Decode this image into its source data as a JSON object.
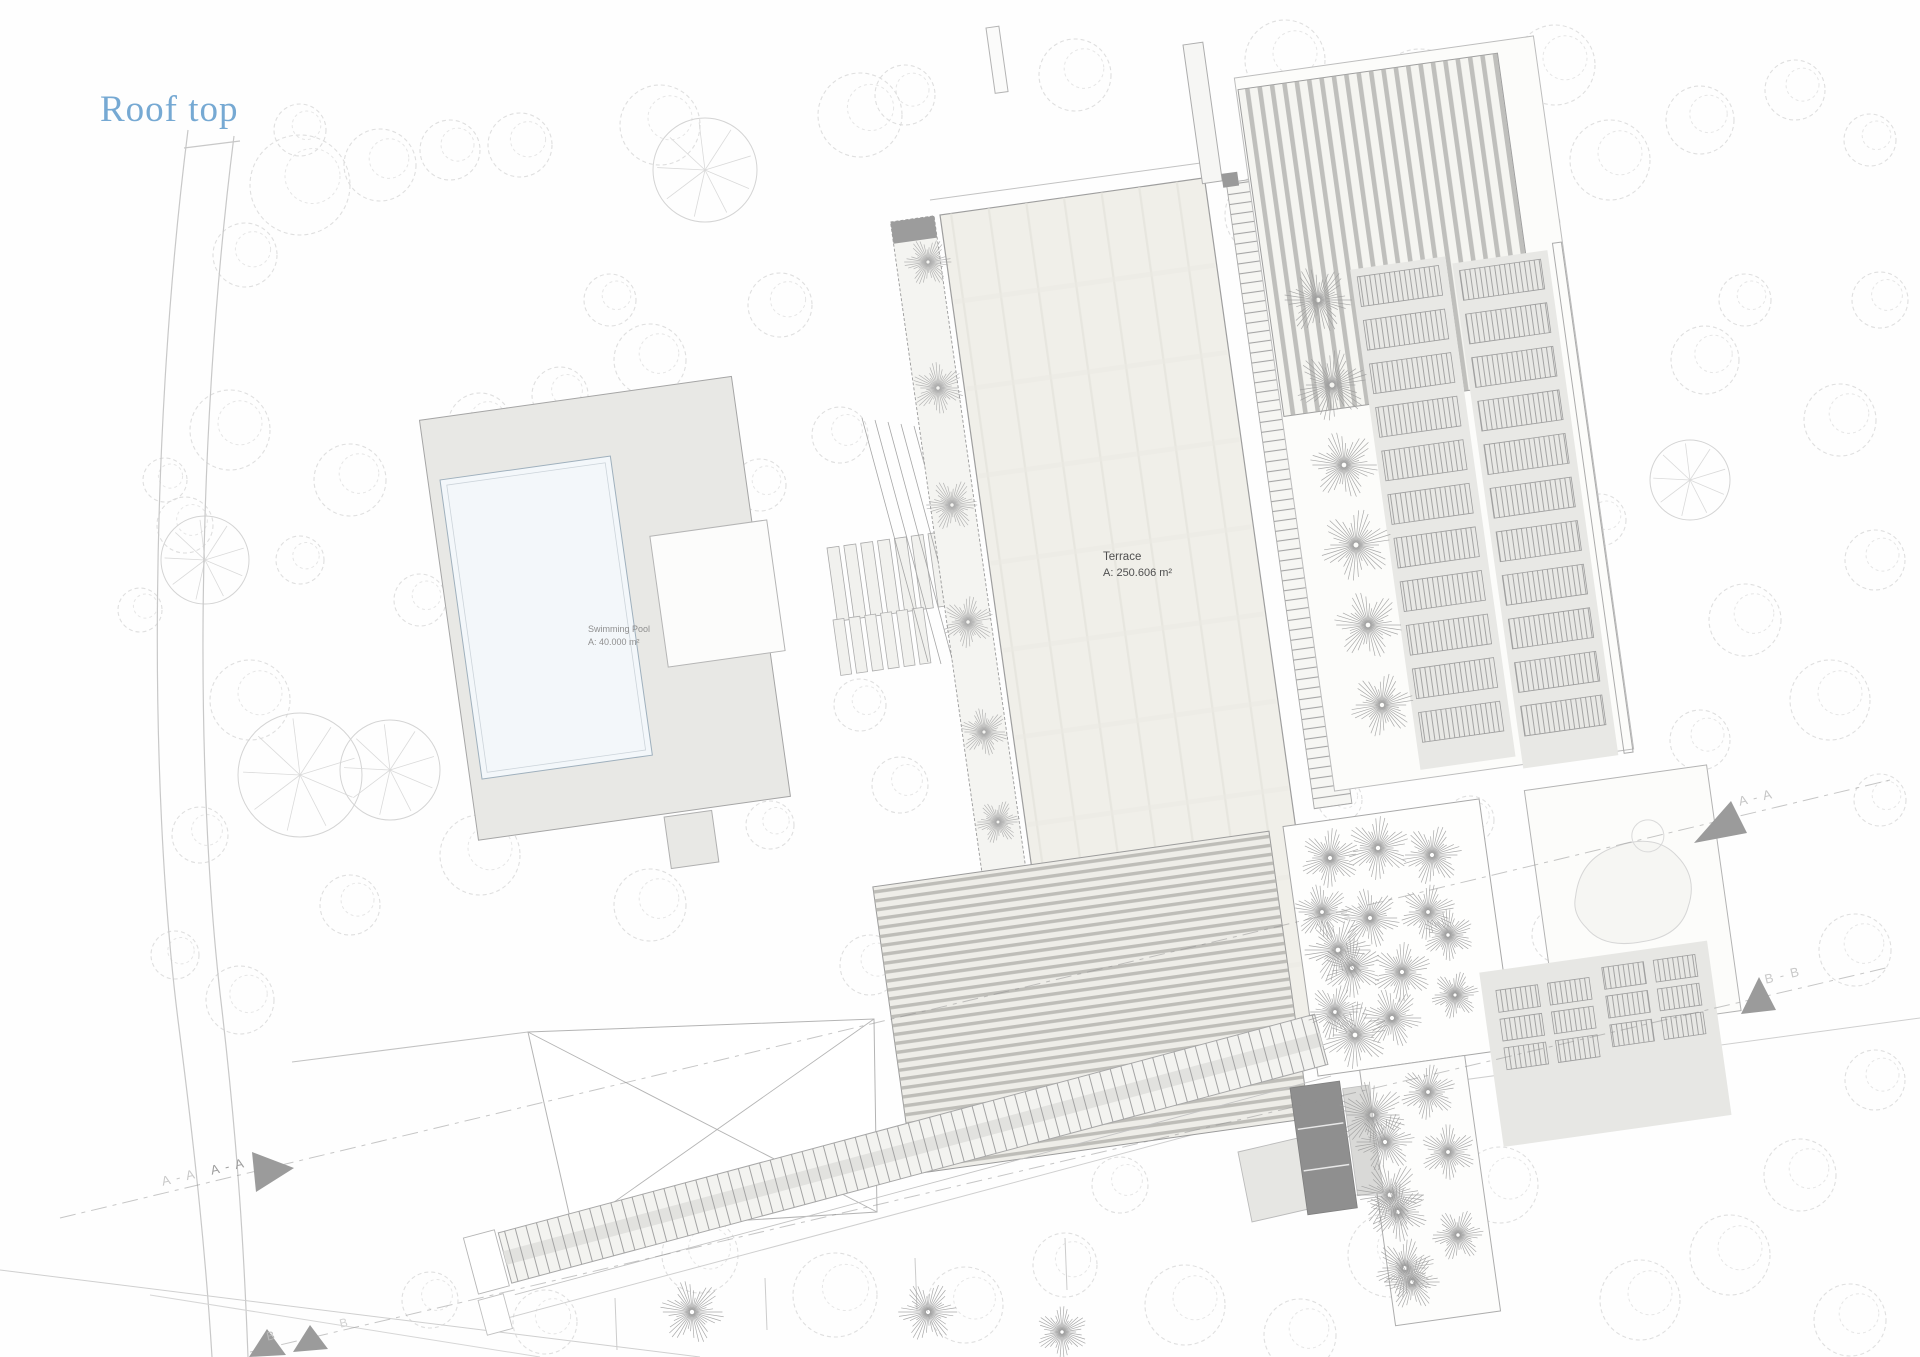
{
  "page": {
    "title": "Roof top"
  },
  "plan_labels": {
    "terrace": {
      "title": "Terrace",
      "area": "A: 250.606 m²"
    },
    "swimming_pool": {
      "title": "Swimming Pool",
      "area": "A: 40.000 m²"
    }
  },
  "section_markers": {
    "left_a_outer": "A - A",
    "left_a_inner": "A - A",
    "right_a": "A - A",
    "right_b": "B - B",
    "bottom_b_left": "B",
    "bottom_b_right": "B"
  },
  "colors": {
    "title": "#76a9d3",
    "slab_fill": "#f0efe9",
    "slab_band": "#e3e2db",
    "deck_fill": "#e8e8e5",
    "pool_fill": "#f3f7fa",
    "band_fill": "#e8e8e5",
    "hatch_line": "#9c9c9c",
    "stripe_line": "#adadab",
    "perg_line": "#b2b1ac",
    "tree_outline": "#dcdcdc",
    "tree_radial": "#a9a9a9",
    "tree_radial_dark": "#9b9b9b",
    "road_line": "#c8c8c8",
    "edge_line": "#a5a5a5",
    "section_line": "#8f8f8f",
    "marker_fill": "#9b9b9b",
    "dark_wall": "#8f8f8f"
  }
}
